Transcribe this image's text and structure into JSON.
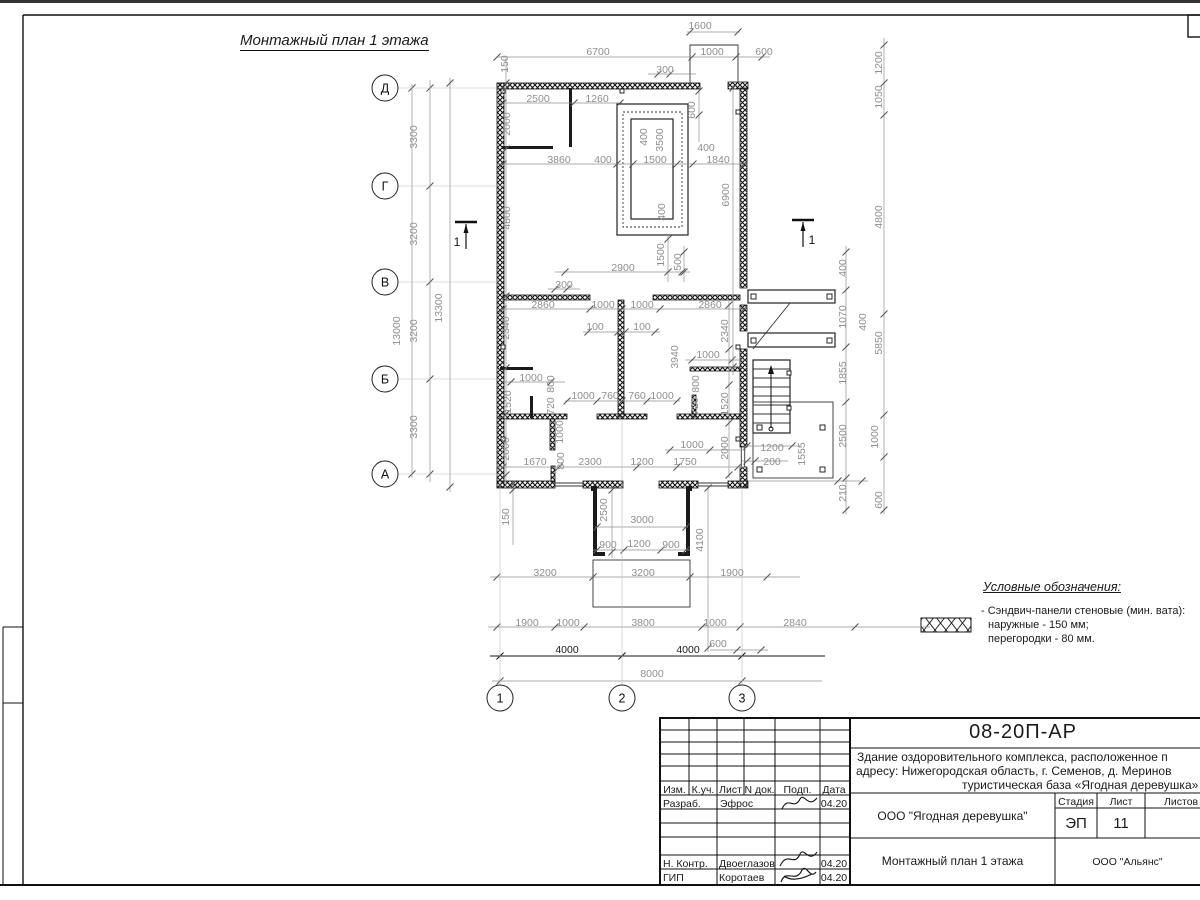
{
  "title": "Монтажный план 1 этажа",
  "legend": {
    "title": "Условные обозначения:",
    "lines": [
      "- Сэндвич-панели стеновые (мин. вата):",
      "наружные - 150 мм;",
      "перегородки - 80 мм."
    ]
  },
  "title_block": {
    "doc_number": "08-20П-АР",
    "description_lines": [
      "Здание оздоровительного комплекса, расположенное п",
      "адресу: Нижегородская область, г. Семенов, д. Меринов",
      "туристическая база «Ягодная деревушка»"
    ],
    "columns_header": [
      "Изм.",
      "К.уч.",
      "Лист",
      "N док.",
      "Подп.",
      "Дата"
    ],
    "rows": [
      {
        "role": "Разраб.",
        "name": "Эфрос",
        "date": "04.20"
      },
      {
        "role": "Н. Контр.",
        "name": "Двоеглазов",
        "date": "04.20"
      },
      {
        "role": "ГИП",
        "name": "Коротаев",
        "date": "04.20"
      }
    ],
    "org_cell": "ООО \"Ягодная деревушка\"",
    "stage_label": "Стадия",
    "sheet_label": "Лист",
    "sheets_label": "Листов",
    "stage": "ЭП",
    "sheet_no": "11",
    "drawing_name": "Монтажный план 1 этажа",
    "company": "ООО \"Альянс\""
  },
  "colors": {
    "line": "#111111",
    "dim": "#8f8f8f",
    "dim_dark": "#1a1a1a",
    "grid": "#bcbcbc",
    "tick": "#555555"
  },
  "plan": {
    "axis_bubbles": [
      {
        "x": 385,
        "y": 88,
        "t": "Д"
      },
      {
        "x": 385,
        "y": 186,
        "t": "Г"
      },
      {
        "x": 385,
        "y": 282,
        "t": "В"
      },
      {
        "x": 385,
        "y": 379,
        "t": "Б"
      },
      {
        "x": 385,
        "y": 474,
        "t": "А"
      },
      {
        "x": 500,
        "y": 698,
        "t": "1"
      },
      {
        "x": 622,
        "y": 698,
        "t": "2"
      },
      {
        "x": 742,
        "y": 698,
        "t": "3"
      }
    ],
    "section_marks": [
      {
        "x": 466,
        "y": 222,
        "dx": -9,
        "t": "1"
      },
      {
        "x": 803,
        "y": 220,
        "dx": 9,
        "t": "1"
      }
    ],
    "chains": [
      {
        "o": "h",
        "c": 32,
        "a": 687,
        "b": 740,
        "t": [
          690,
          738
        ]
      },
      {
        "o": "h",
        "c": 57,
        "a": 497,
        "b": 770,
        "t": [
          497,
          692,
          736,
          762
        ]
      },
      {
        "o": "h",
        "c": 74,
        "a": 648,
        "b": 696,
        "t": [
          658,
          670
        ]
      },
      {
        "o": "h",
        "c": 103,
        "a": 497,
        "b": 622,
        "t": [
          503,
          574,
          620
        ]
      },
      {
        "o": "h",
        "c": 164,
        "a": 497,
        "b": 748,
        "t": [
          503,
          617,
          633,
          677,
          693,
          744
        ]
      },
      {
        "o": "h",
        "c": 272,
        "a": 555,
        "b": 690,
        "t": [
          565,
          682
        ]
      },
      {
        "o": "h",
        "c": 289,
        "a": 548,
        "b": 580,
        "t": [
          555,
          567
        ]
      },
      {
        "o": "h",
        "c": 309,
        "a": 497,
        "b": 748,
        "t": [
          503,
          590,
          622,
          660,
          744
        ]
      },
      {
        "o": "h",
        "c": 332,
        "a": 583,
        "b": 660,
        "t": [
          588,
          618,
          625,
          655
        ]
      },
      {
        "o": "h",
        "c": 360,
        "a": 685,
        "b": 745,
        "t": [
          692,
          732
        ]
      },
      {
        "o": "h",
        "c": 382,
        "a": 503,
        "b": 565,
        "t": [
          511,
          551
        ]
      },
      {
        "o": "h",
        "c": 401,
        "a": 565,
        "b": 680,
        "t": [
          567,
          597,
          622,
          647,
          677
        ]
      },
      {
        "o": "h",
        "c": 450,
        "a": 665,
        "b": 746,
        "t": [
          670,
          710
        ]
      },
      {
        "o": "h",
        "c": 446,
        "a": 742,
        "b": 800,
        "t": [
          747,
          792
        ]
      },
      {
        "o": "h",
        "c": 461,
        "a": 742,
        "b": 788,
        "t": [
          747,
          755
        ]
      },
      {
        "o": "h",
        "c": 467,
        "a": 497,
        "b": 744,
        "t": [
          503,
          559,
          637,
          677,
          738
        ]
      },
      {
        "o": "h",
        "c": 481,
        "a": 748,
        "b": 868,
        "t": [
          838,
          862
        ]
      },
      {
        "o": "h",
        "c": 527,
        "a": 595,
        "b": 688,
        "t": [
          597,
          686
        ]
      },
      {
        "o": "h",
        "c": 550,
        "a": 593,
        "b": 690,
        "t": [
          597,
          624,
          661,
          686
        ]
      },
      {
        "o": "h",
        "c": 577,
        "a": 490,
        "b": 800,
        "t": [
          497,
          593,
          690,
          767
        ]
      },
      {
        "o": "h",
        "c": 627,
        "a": 488,
        "b": 930,
        "t": [
          497,
          555,
          584,
          702,
          740,
          855
        ]
      },
      {
        "o": "h",
        "c": 650,
        "a": 710,
        "b": 768,
        "t": [
          737,
          761
        ]
      },
      {
        "o": "h",
        "c": 656,
        "a": 490,
        "b": 825,
        "t": [
          500,
          622,
          742
        ],
        "d": 1
      },
      {
        "o": "h",
        "c": 681,
        "a": 492,
        "b": 822,
        "t": [
          500,
          742
        ]
      },
      {
        "o": "v",
        "c": 430,
        "a": 80,
        "b": 482,
        "t": [
          88,
          186,
          282,
          379,
          474
        ]
      },
      {
        "o": "v",
        "c": 412,
        "a": 84,
        "b": 478,
        "t": [
          88,
          474
        ]
      },
      {
        "o": "v",
        "c": 450,
        "a": 78,
        "b": 492,
        "t": [
          83,
          487
        ]
      },
      {
        "o": "v",
        "c": 506,
        "a": 58,
        "b": 487,
        "t": [
          83,
          88,
          149,
          296,
          368,
          414,
          475
        ]
      },
      {
        "o": "v",
        "c": 699,
        "a": 88,
        "b": 142,
        "t": [
          91,
          115
        ]
      },
      {
        "o": "v",
        "c": 733,
        "a": 85,
        "b": 375,
        "t": [
          88,
          367
        ]
      },
      {
        "o": "v",
        "c": 729,
        "a": 300,
        "b": 478,
        "t": [
          305,
          349,
          385,
          423,
          475
        ]
      },
      {
        "o": "v",
        "c": 846,
        "a": 246,
        "b": 514,
        "t": [
          252,
          290,
          347,
          402,
          478,
          510
        ]
      },
      {
        "o": "v",
        "c": 884,
        "a": 38,
        "b": 514,
        "t": [
          45,
          83,
          115,
          314,
          415,
          457,
          510
        ]
      },
      {
        "o": "v",
        "c": 612,
        "a": 486,
        "b": 558,
        "t": [
          490,
          552
        ]
      },
      {
        "o": "v",
        "c": 513,
        "a": 481,
        "b": 545,
        "t": [
          484,
          490
        ]
      },
      {
        "o": "v",
        "c": 708,
        "a": 486,
        "b": 652,
        "t": [
          488,
          648
        ]
      },
      {
        "o": "v",
        "c": 668,
        "a": 235,
        "b": 282,
        "t": [
          239,
          272
        ]
      },
      {
        "o": "v",
        "c": 684,
        "a": 246,
        "b": 282,
        "t": [
          252,
          272
        ]
      },
      {
        "o": "h",
        "c": 88,
        "a": 398,
        "b": 506,
        "g": 1
      },
      {
        "o": "h",
        "c": 186,
        "a": 398,
        "b": 506,
        "g": 1
      },
      {
        "o": "h",
        "c": 282,
        "a": 398,
        "b": 500,
        "g": 1
      },
      {
        "o": "h",
        "c": 379,
        "a": 398,
        "b": 500,
        "g": 1
      },
      {
        "o": "h",
        "c": 474,
        "a": 398,
        "b": 500,
        "g": 1
      },
      {
        "o": "v",
        "c": 500,
        "a": 481,
        "b": 685,
        "g": 1
      },
      {
        "o": "v",
        "c": 622,
        "a": 420,
        "b": 685,
        "g": 1
      },
      {
        "o": "v",
        "c": 742,
        "a": 481,
        "b": 685,
        "g": 1
      }
    ],
    "dim_labels": [
      {
        "x": 700,
        "y": 26,
        "t": "1600"
      },
      {
        "x": 598,
        "y": 52,
        "t": "6700"
      },
      {
        "x": 712,
        "y": 52,
        "t": "1000"
      },
      {
        "x": 764,
        "y": 52,
        "t": "600"
      },
      {
        "x": 665,
        "y": 70,
        "t": "300"
      },
      {
        "x": 538,
        "y": 99,
        "t": "2500"
      },
      {
        "x": 597,
        "y": 99,
        "t": "1260"
      },
      {
        "x": 508,
        "y": 64,
        "t": "150",
        "r": 1
      },
      {
        "x": 510,
        "y": 124,
        "t": "2000",
        "r": 1
      },
      {
        "x": 695,
        "y": 110,
        "t": "600",
        "r": 1
      },
      {
        "x": 559,
        "y": 160,
        "t": "3860"
      },
      {
        "x": 603,
        "y": 160,
        "t": "400"
      },
      {
        "x": 655,
        "y": 160,
        "t": "1500"
      },
      {
        "x": 706,
        "y": 148,
        "t": "400"
      },
      {
        "x": 718,
        "y": 160,
        "t": "1840"
      },
      {
        "x": 647,
        "y": 137,
        "t": "400",
        "r": 1
      },
      {
        "x": 663,
        "y": 140,
        "t": "3500",
        "r": 1
      },
      {
        "x": 665,
        "y": 212,
        "t": "400",
        "r": 1
      },
      {
        "x": 729,
        "y": 195,
        "t": "6900",
        "r": 1
      },
      {
        "x": 510,
        "y": 218,
        "t": "4800",
        "r": 1
      },
      {
        "x": 664,
        "y": 255,
        "t": "1500",
        "r": 1
      },
      {
        "x": 681,
        "y": 262,
        "t": "500",
        "r": 1
      },
      {
        "x": 623,
        "y": 268,
        "t": "2900"
      },
      {
        "x": 564,
        "y": 285,
        "t": "300"
      },
      {
        "x": 543,
        "y": 305,
        "t": "2860"
      },
      {
        "x": 603,
        "y": 305,
        "t": "1000"
      },
      {
        "x": 642,
        "y": 305,
        "t": "1000"
      },
      {
        "x": 710,
        "y": 305,
        "t": "2860"
      },
      {
        "x": 595,
        "y": 327,
        "t": "100"
      },
      {
        "x": 642,
        "y": 327,
        "t": "100"
      },
      {
        "x": 509,
        "y": 328,
        "t": "2340",
        "r": 1
      },
      {
        "x": 728,
        "y": 331,
        "t": "2340",
        "r": 1
      },
      {
        "x": 678,
        "y": 357,
        "t": "3940",
        "r": 1
      },
      {
        "x": 708,
        "y": 355,
        "t": "1000"
      },
      {
        "x": 531,
        "y": 378,
        "t": "1000"
      },
      {
        "x": 554,
        "y": 384,
        "t": "800",
        "r": 1
      },
      {
        "x": 554,
        "y": 406,
        "t": "720",
        "r": 1
      },
      {
        "x": 511,
        "y": 402,
        "t": "1520",
        "r": 1
      },
      {
        "x": 699,
        "y": 384,
        "t": "800",
        "r": 1
      },
      {
        "x": 698,
        "y": 406,
        "t": "720",
        "r": 1
      },
      {
        "x": 728,
        "y": 404,
        "t": "1520",
        "r": 1
      },
      {
        "x": 583,
        "y": 396,
        "t": "1000"
      },
      {
        "x": 610,
        "y": 396,
        "t": "760"
      },
      {
        "x": 637,
        "y": 396,
        "t": "760"
      },
      {
        "x": 662,
        "y": 396,
        "t": "1000"
      },
      {
        "x": 509,
        "y": 449,
        "t": "2000",
        "r": 1
      },
      {
        "x": 728,
        "y": 448,
        "t": "2000",
        "r": 1
      },
      {
        "x": 563,
        "y": 432,
        "t": "1000",
        "r": 1
      },
      {
        "x": 564,
        "y": 461,
        "t": "800",
        "r": 1
      },
      {
        "x": 535,
        "y": 462,
        "t": "1670"
      },
      {
        "x": 590,
        "y": 462,
        "t": "2300"
      },
      {
        "x": 642,
        "y": 462,
        "t": "1200"
      },
      {
        "x": 685,
        "y": 462,
        "t": "1750"
      },
      {
        "x": 692,
        "y": 445,
        "t": "1000"
      },
      {
        "x": 772,
        "y": 448,
        "t": "1200"
      },
      {
        "x": 772,
        "y": 462,
        "t": "200"
      },
      {
        "x": 805,
        "y": 454,
        "t": "1555",
        "r": 1
      },
      {
        "x": 846,
        "y": 268,
        "t": "400",
        "r": 1
      },
      {
        "x": 846,
        "y": 317,
        "t": "1070",
        "r": 1
      },
      {
        "x": 866,
        "y": 322,
        "t": "400",
        "r": 1
      },
      {
        "x": 846,
        "y": 373,
        "t": "1855",
        "r": 1
      },
      {
        "x": 846,
        "y": 436,
        "t": "2500",
        "r": 1
      },
      {
        "x": 846,
        "y": 493,
        "t": "210",
        "r": 1
      },
      {
        "x": 882,
        "y": 63,
        "t": "1200",
        "r": 1
      },
      {
        "x": 882,
        "y": 97,
        "t": "1050",
        "r": 1
      },
      {
        "x": 882,
        "y": 217,
        "t": "4800",
        "r": 1
      },
      {
        "x": 882,
        "y": 343,
        "t": "5850",
        "r": 1
      },
      {
        "x": 878,
        "y": 437,
        "t": "1000",
        "r": 1
      },
      {
        "x": 882,
        "y": 500,
        "t": "600",
        "r": 1
      },
      {
        "x": 417,
        "y": 137,
        "t": "3300",
        "r": 1
      },
      {
        "x": 417,
        "y": 234,
        "t": "3200",
        "r": 1
      },
      {
        "x": 417,
        "y": 331,
        "t": "3200",
        "r": 1
      },
      {
        "x": 417,
        "y": 427,
        "t": "3300",
        "r": 1
      },
      {
        "x": 400,
        "y": 331,
        "t": "13000",
        "r": 1
      },
      {
        "x": 442,
        "y": 308,
        "t": "13300",
        "r": 1
      },
      {
        "x": 509,
        "y": 517,
        "t": "150",
        "r": 1
      },
      {
        "x": 607,
        "y": 510,
        "t": "2500",
        "r": 1
      },
      {
        "x": 642,
        "y": 520,
        "t": "3000"
      },
      {
        "x": 608,
        "y": 545,
        "t": "900"
      },
      {
        "x": 639,
        "y": 544,
        "t": "1200"
      },
      {
        "x": 671,
        "y": 545,
        "t": "900"
      },
      {
        "x": 703,
        "y": 540,
        "t": "4100",
        "r": 1
      },
      {
        "x": 545,
        "y": 573,
        "t": "3200"
      },
      {
        "x": 643,
        "y": 573,
        "t": "3200"
      },
      {
        "x": 732,
        "y": 573,
        "t": "1900"
      },
      {
        "x": 527,
        "y": 623,
        "t": "1900"
      },
      {
        "x": 568,
        "y": 623,
        "t": "1000"
      },
      {
        "x": 643,
        "y": 623,
        "t": "3800"
      },
      {
        "x": 715,
        "y": 623,
        "t": "1000"
      },
      {
        "x": 795,
        "y": 623,
        "t": "2840"
      },
      {
        "x": 718,
        "y": 644,
        "t": "600"
      },
      {
        "x": 567,
        "y": 650,
        "t": "4000",
        "d": 1
      },
      {
        "x": 688,
        "y": 650,
        "t": "4000",
        "d": 1
      },
      {
        "x": 652,
        "y": 674,
        "t": "8000"
      }
    ]
  }
}
